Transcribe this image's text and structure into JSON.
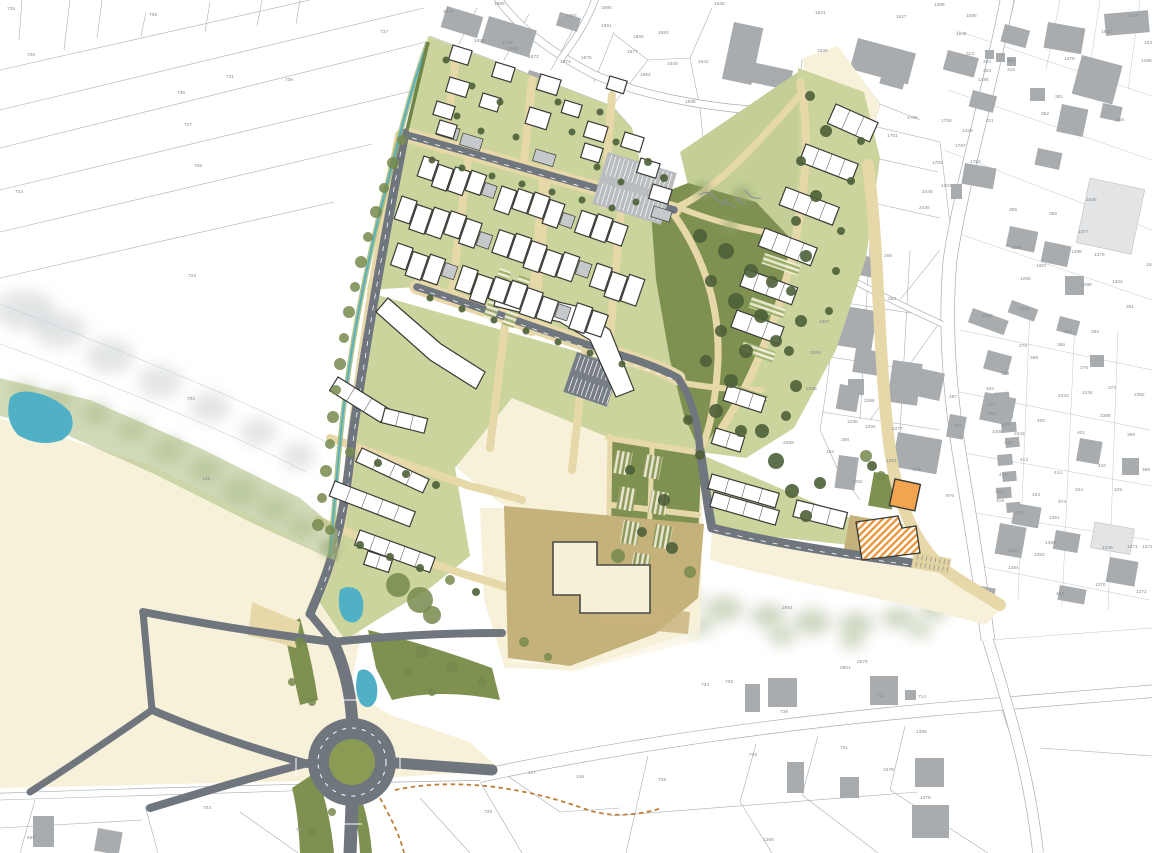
{
  "map": {
    "title": "Residential development masterplan – site plan",
    "type": "urban-masterplan",
    "colors": {
      "road": "#70767e",
      "path": "#e7d8aa",
      "site_green": "#cbd49d",
      "park": "#7e9150",
      "field": "#f8f1da",
      "tan": "#c5b27a",
      "water": "#4fb0c6",
      "building_new": "#ffffff",
      "building_old": "#a8acaf",
      "orange": "#f2a44e",
      "label": "#878d92",
      "line": "#9aa0a5",
      "accent_dash": "#bf7e3a"
    },
    "parcel_labels": [
      [
        "725",
        7,
        10
      ],
      [
        "735",
        149,
        16
      ],
      [
        "728",
        27,
        56
      ],
      [
        "731",
        226,
        78
      ],
      [
        "736",
        285,
        81
      ],
      [
        "738",
        177,
        94
      ],
      [
        "727",
        184,
        126
      ],
      [
        "726",
        194,
        167
      ],
      [
        "724",
        15,
        193
      ],
      [
        "723",
        188,
        277
      ],
      [
        "737",
        380,
        33
      ],
      [
        "702",
        187,
        400
      ],
      [
        "125",
        202,
        480
      ],
      [
        "3970",
        443,
        13
      ],
      [
        "1895",
        494,
        5
      ],
      [
        "1890",
        601,
        9
      ],
      [
        "1892",
        566,
        17
      ],
      [
        "1891",
        601,
        27
      ],
      [
        "1884",
        633,
        38
      ],
      [
        "1883",
        658,
        34
      ],
      [
        "1877",
        627,
        53
      ],
      [
        "1873",
        528,
        58
      ],
      [
        "1874",
        560,
        63
      ],
      [
        "1875",
        581,
        59
      ],
      [
        "1963",
        640,
        76
      ],
      [
        "1640",
        667,
        65
      ],
      [
        "1642",
        698,
        63
      ],
      [
        "1595",
        685,
        103
      ],
      [
        "1896",
        474,
        42
      ],
      [
        "1889",
        502,
        44
      ],
      [
        "1888",
        507,
        50
      ],
      [
        "1628",
        714,
        5
      ],
      [
        "1621",
        815,
        14
      ],
      [
        "1625",
        817,
        52
      ],
      [
        "1627",
        896,
        18
      ],
      [
        "1386",
        934,
        6
      ],
      [
        "1685",
        966,
        17
      ],
      [
        "1646",
        956,
        35
      ],
      [
        "2410",
        1128,
        17
      ],
      [
        "1962",
        1101,
        33
      ],
      [
        "1636",
        1144,
        44
      ],
      [
        "1498",
        1141,
        62
      ],
      [
        "1378",
        1064,
        60
      ],
      [
        "313",
        966,
        55
      ],
      [
        "304",
        983,
        63
      ],
      [
        "306",
        1007,
        62
      ],
      [
        "303",
        983,
        72
      ],
      [
        "315",
        1007,
        71
      ],
      [
        "1385",
        978,
        81
      ],
      [
        "351",
        1055,
        98
      ],
      [
        "352",
        1041,
        115
      ],
      [
        "358",
        1116,
        121
      ],
      [
        "311",
        986,
        122
      ],
      [
        "1429",
        962,
        132
      ],
      [
        "1787",
        955,
        147
      ],
      [
        "1782",
        970,
        163
      ],
      [
        "1705",
        907,
        119
      ],
      [
        "1706",
        941,
        122
      ],
      [
        "1701",
        887,
        137
      ],
      [
        "1703",
        932,
        164
      ],
      [
        "1603",
        941,
        187
      ],
      [
        "2445",
        922,
        193
      ],
      [
        "2446",
        919,
        209
      ],
      [
        "1626",
        1086,
        201
      ],
      [
        "355",
        1009,
        211
      ],
      [
        "356",
        1049,
        215
      ],
      [
        "1377",
        1078,
        233
      ],
      [
        "1396",
        1011,
        249
      ],
      [
        "1398",
        1071,
        253
      ],
      [
        "1375",
        1094,
        256
      ],
      [
        "1057",
        1036,
        267
      ],
      [
        "1056",
        1020,
        280
      ],
      [
        "1488",
        1081,
        286
      ],
      [
        "1302",
        1112,
        283
      ],
      [
        "2485",
        1146,
        266
      ],
      [
        "295",
        884,
        257
      ],
      [
        "293",
        888,
        300
      ],
      [
        "2367",
        819,
        323
      ],
      [
        "2368",
        810,
        354
      ],
      [
        "2365",
        806,
        390
      ],
      [
        "2366",
        864,
        402
      ],
      [
        "287",
        949,
        398
      ],
      [
        "1295",
        847,
        423
      ],
      [
        "1294",
        865,
        428
      ],
      [
        "2277",
        892,
        430
      ],
      [
        "286",
        954,
        427
      ],
      [
        "2369",
        783,
        444
      ],
      [
        "288",
        841,
        441
      ],
      [
        "152",
        826,
        453
      ],
      [
        "1291",
        886,
        462
      ],
      [
        "975",
        913,
        471
      ],
      [
        "1252",
        852,
        483
      ],
      [
        "976",
        946,
        497
      ],
      [
        "1353",
        982,
        317
      ],
      [
        "1354",
        1019,
        310
      ],
      [
        "361",
        1126,
        308
      ],
      [
        "363",
        1064,
        333
      ],
      [
        "362",
        1091,
        333
      ],
      [
        "366",
        1057,
        346
      ],
      [
        "275",
        1019,
        347
      ],
      [
        "368",
        1030,
        359
      ],
      [
        "369",
        1001,
        375
      ],
      [
        "376",
        1080,
        369
      ],
      [
        "374",
        1108,
        389
      ],
      [
        "2382",
        1134,
        396
      ],
      [
        "2433",
        1058,
        397
      ],
      [
        "2434",
        1082,
        394
      ],
      [
        "2386",
        1100,
        417
      ],
      [
        "404",
        986,
        390
      ],
      [
        "405",
        987,
        406
      ],
      [
        "406",
        987,
        415
      ],
      [
        "407",
        1002,
        426
      ],
      [
        "2405",
        992,
        433
      ],
      [
        "2342",
        1014,
        435
      ],
      [
        "403",
        1004,
        444
      ],
      [
        "400",
        1037,
        422
      ],
      [
        "401",
        1077,
        434
      ],
      [
        "399",
        1127,
        436
      ],
      [
        "413",
        1020,
        461
      ],
      [
        "414",
        1054,
        474
      ],
      [
        "410",
        1098,
        467
      ],
      [
        "398",
        1142,
        471
      ],
      [
        "415",
        999,
        476
      ],
      [
        "418",
        995,
        493
      ],
      [
        "419",
        996,
        502
      ],
      [
        "423",
        1032,
        496
      ],
      [
        "424",
        1075,
        491
      ],
      [
        "425",
        1114,
        491
      ],
      [
        "974",
        1058,
        503
      ],
      [
        "470",
        1015,
        514
      ],
      [
        "1351",
        1049,
        519
      ],
      [
        "1369",
        1045,
        544
      ],
      [
        "1362",
        1034,
        556
      ],
      [
        "1363",
        1008,
        552
      ],
      [
        "1364",
        1008,
        569
      ],
      [
        "1349",
        1102,
        549
      ],
      [
        "1371",
        1127,
        548
      ],
      [
        "1373",
        1142,
        548
      ],
      [
        "1370",
        1095,
        586
      ],
      [
        "1372",
        1136,
        593
      ],
      [
        "435",
        1056,
        595
      ],
      [
        "2981",
        782,
        609
      ],
      [
        "2679",
        857,
        663
      ],
      [
        "2901",
        840,
        669
      ],
      [
        "734",
        701,
        686
      ],
      [
        "735",
        725,
        683
      ],
      [
        "739",
        780,
        713
      ],
      [
        "712",
        876,
        697
      ],
      [
        "714",
        918,
        698
      ],
      [
        "1388",
        916,
        733
      ],
      [
        "729",
        658,
        781
      ],
      [
        "726",
        749,
        756
      ],
      [
        "701",
        840,
        749
      ],
      [
        "1379",
        883,
        771
      ],
      [
        "1378",
        920,
        799
      ],
      [
        "1366",
        763,
        841
      ],
      [
        "147",
        528,
        774
      ],
      [
        "146",
        576,
        778
      ],
      [
        "728",
        484,
        813
      ],
      [
        "703",
        203,
        809
      ],
      [
        "763",
        296,
        831
      ],
      [
        "566",
        27,
        839
      ]
    ]
  }
}
